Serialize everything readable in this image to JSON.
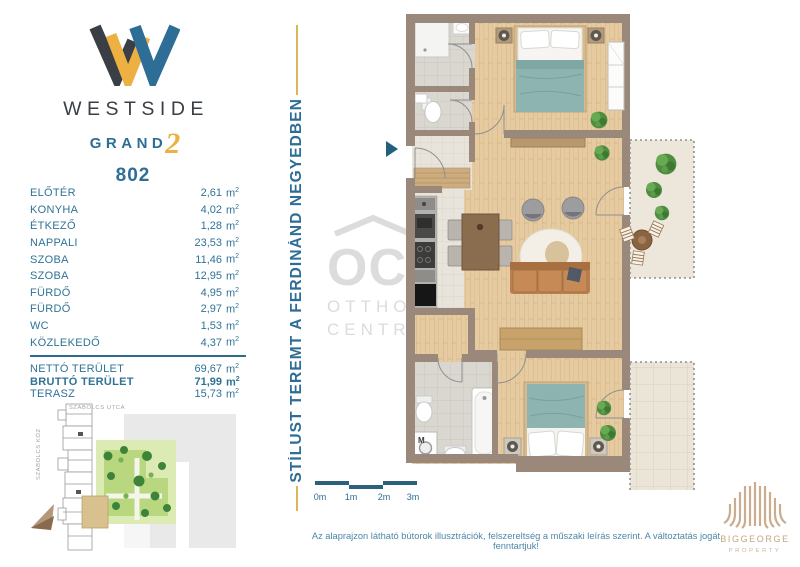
{
  "brand": {
    "wordmark": "WESTSIDE",
    "sub": "GRAND",
    "sub_number": "2",
    "unit_number": "802"
  },
  "unit": {
    "base": "m",
    "sup": "2"
  },
  "rooms": [
    {
      "label": "ELŐTÉR",
      "area": "2,61"
    },
    {
      "label": "KONYHA",
      "area": "4,02"
    },
    {
      "label": "ÉTKEZŐ",
      "area": "1,28"
    },
    {
      "label": "NAPPALI",
      "area": "23,53"
    },
    {
      "label": "SZOBA",
      "area": "11,46"
    },
    {
      "label": "SZOBA",
      "area": "12,95"
    },
    {
      "label": "FÜRDŐ",
      "area": "4,95"
    },
    {
      "label": "FÜRDŐ",
      "area": "2,97"
    },
    {
      "label": "WC",
      "area": "1,53"
    },
    {
      "label": "KÖZLEKEDŐ",
      "area": "4,37"
    }
  ],
  "totals": {
    "rows": [
      {
        "label": "NETTÓ TERÜLET",
        "area": "69,67"
      },
      {
        "label": "BRUTTÓ TERÜLET",
        "area": "71,99"
      },
      {
        "label": "TERASZ",
        "area": "15,73"
      }
    ]
  },
  "banner": {
    "text": "STÍLUST TEREMT A FERDINÁND NEGYEDBEN"
  },
  "site_map": {
    "street_top": "SZABOLCS UTCA",
    "street_left": "SZABOLCS KÖZ"
  },
  "floor_plan": {
    "washer_label": "M",
    "dishwasher_label": "MO",
    "watermark": {
      "mark": "OC",
      "line1": "OTTHON",
      "line2": "CENTRUM"
    }
  },
  "scale_bar": {
    "labels": [
      "0m",
      "1m",
      "2m",
      "3m"
    ]
  },
  "footer": {
    "disclaimer": "Az alaprajzon látható bútorok illusztrációk, felszereltség a műszaki leírás szerint. A változtatás jogát fenntartjuk!"
  },
  "partner": {
    "name": "BIGGEORGE",
    "division": "PROPERTY"
  },
  "colors": {
    "brand_blue": "#2e6d96",
    "brand_gold": "#edb042",
    "brand_charcoal": "#3a3f46",
    "list_text": "#2f7396",
    "wall": "#9a897b",
    "wood_floor": "#e6cba1",
    "bed_teal": "#8db4b0",
    "sofa_tan": "#c68a57",
    "scale_bar": "#2d607c",
    "partner_tan": "#c9ad8e"
  }
}
